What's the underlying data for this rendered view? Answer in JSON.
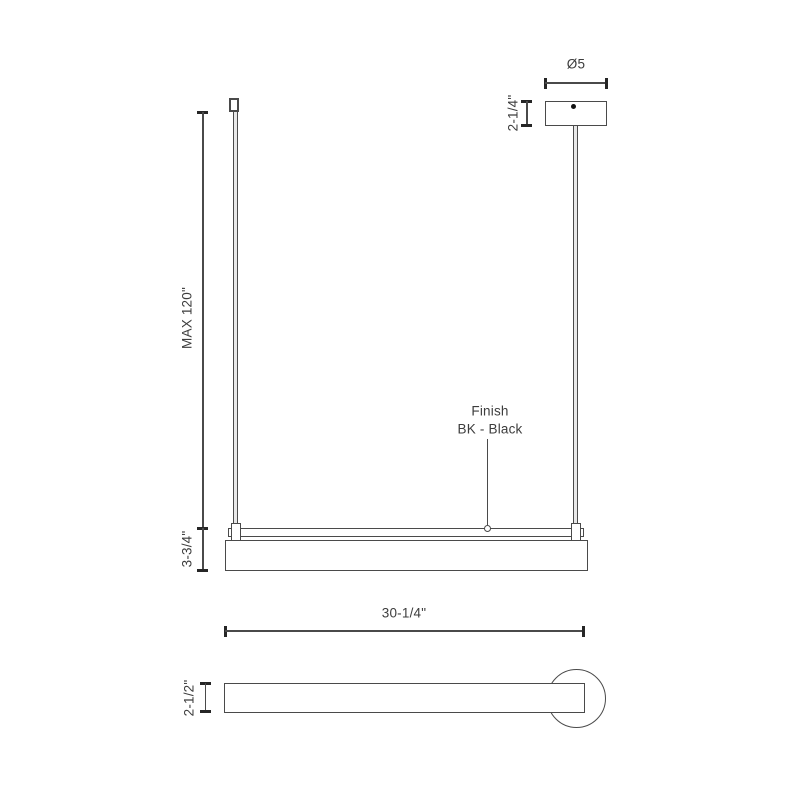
{
  "drawing": {
    "type": "technical-dimension-drawing",
    "subject": "linear pendant light fixture",
    "line_color": "#4a4a4a",
    "text_color": "#3d3d3d",
    "views": {
      "front": {
        "canopy_diameter_label": "Ø5",
        "canopy_height_label": "2-1/4\"",
        "suspension_max_label": "MAX 120\"",
        "fixture_height_label": "3-3/4\"",
        "finish_callout_line1": "Finish",
        "finish_callout_line2": "BK - Black"
      },
      "width_dimension_label": "30-1/4\"",
      "side": {
        "body_height_label": "2-1/2\""
      }
    }
  }
}
